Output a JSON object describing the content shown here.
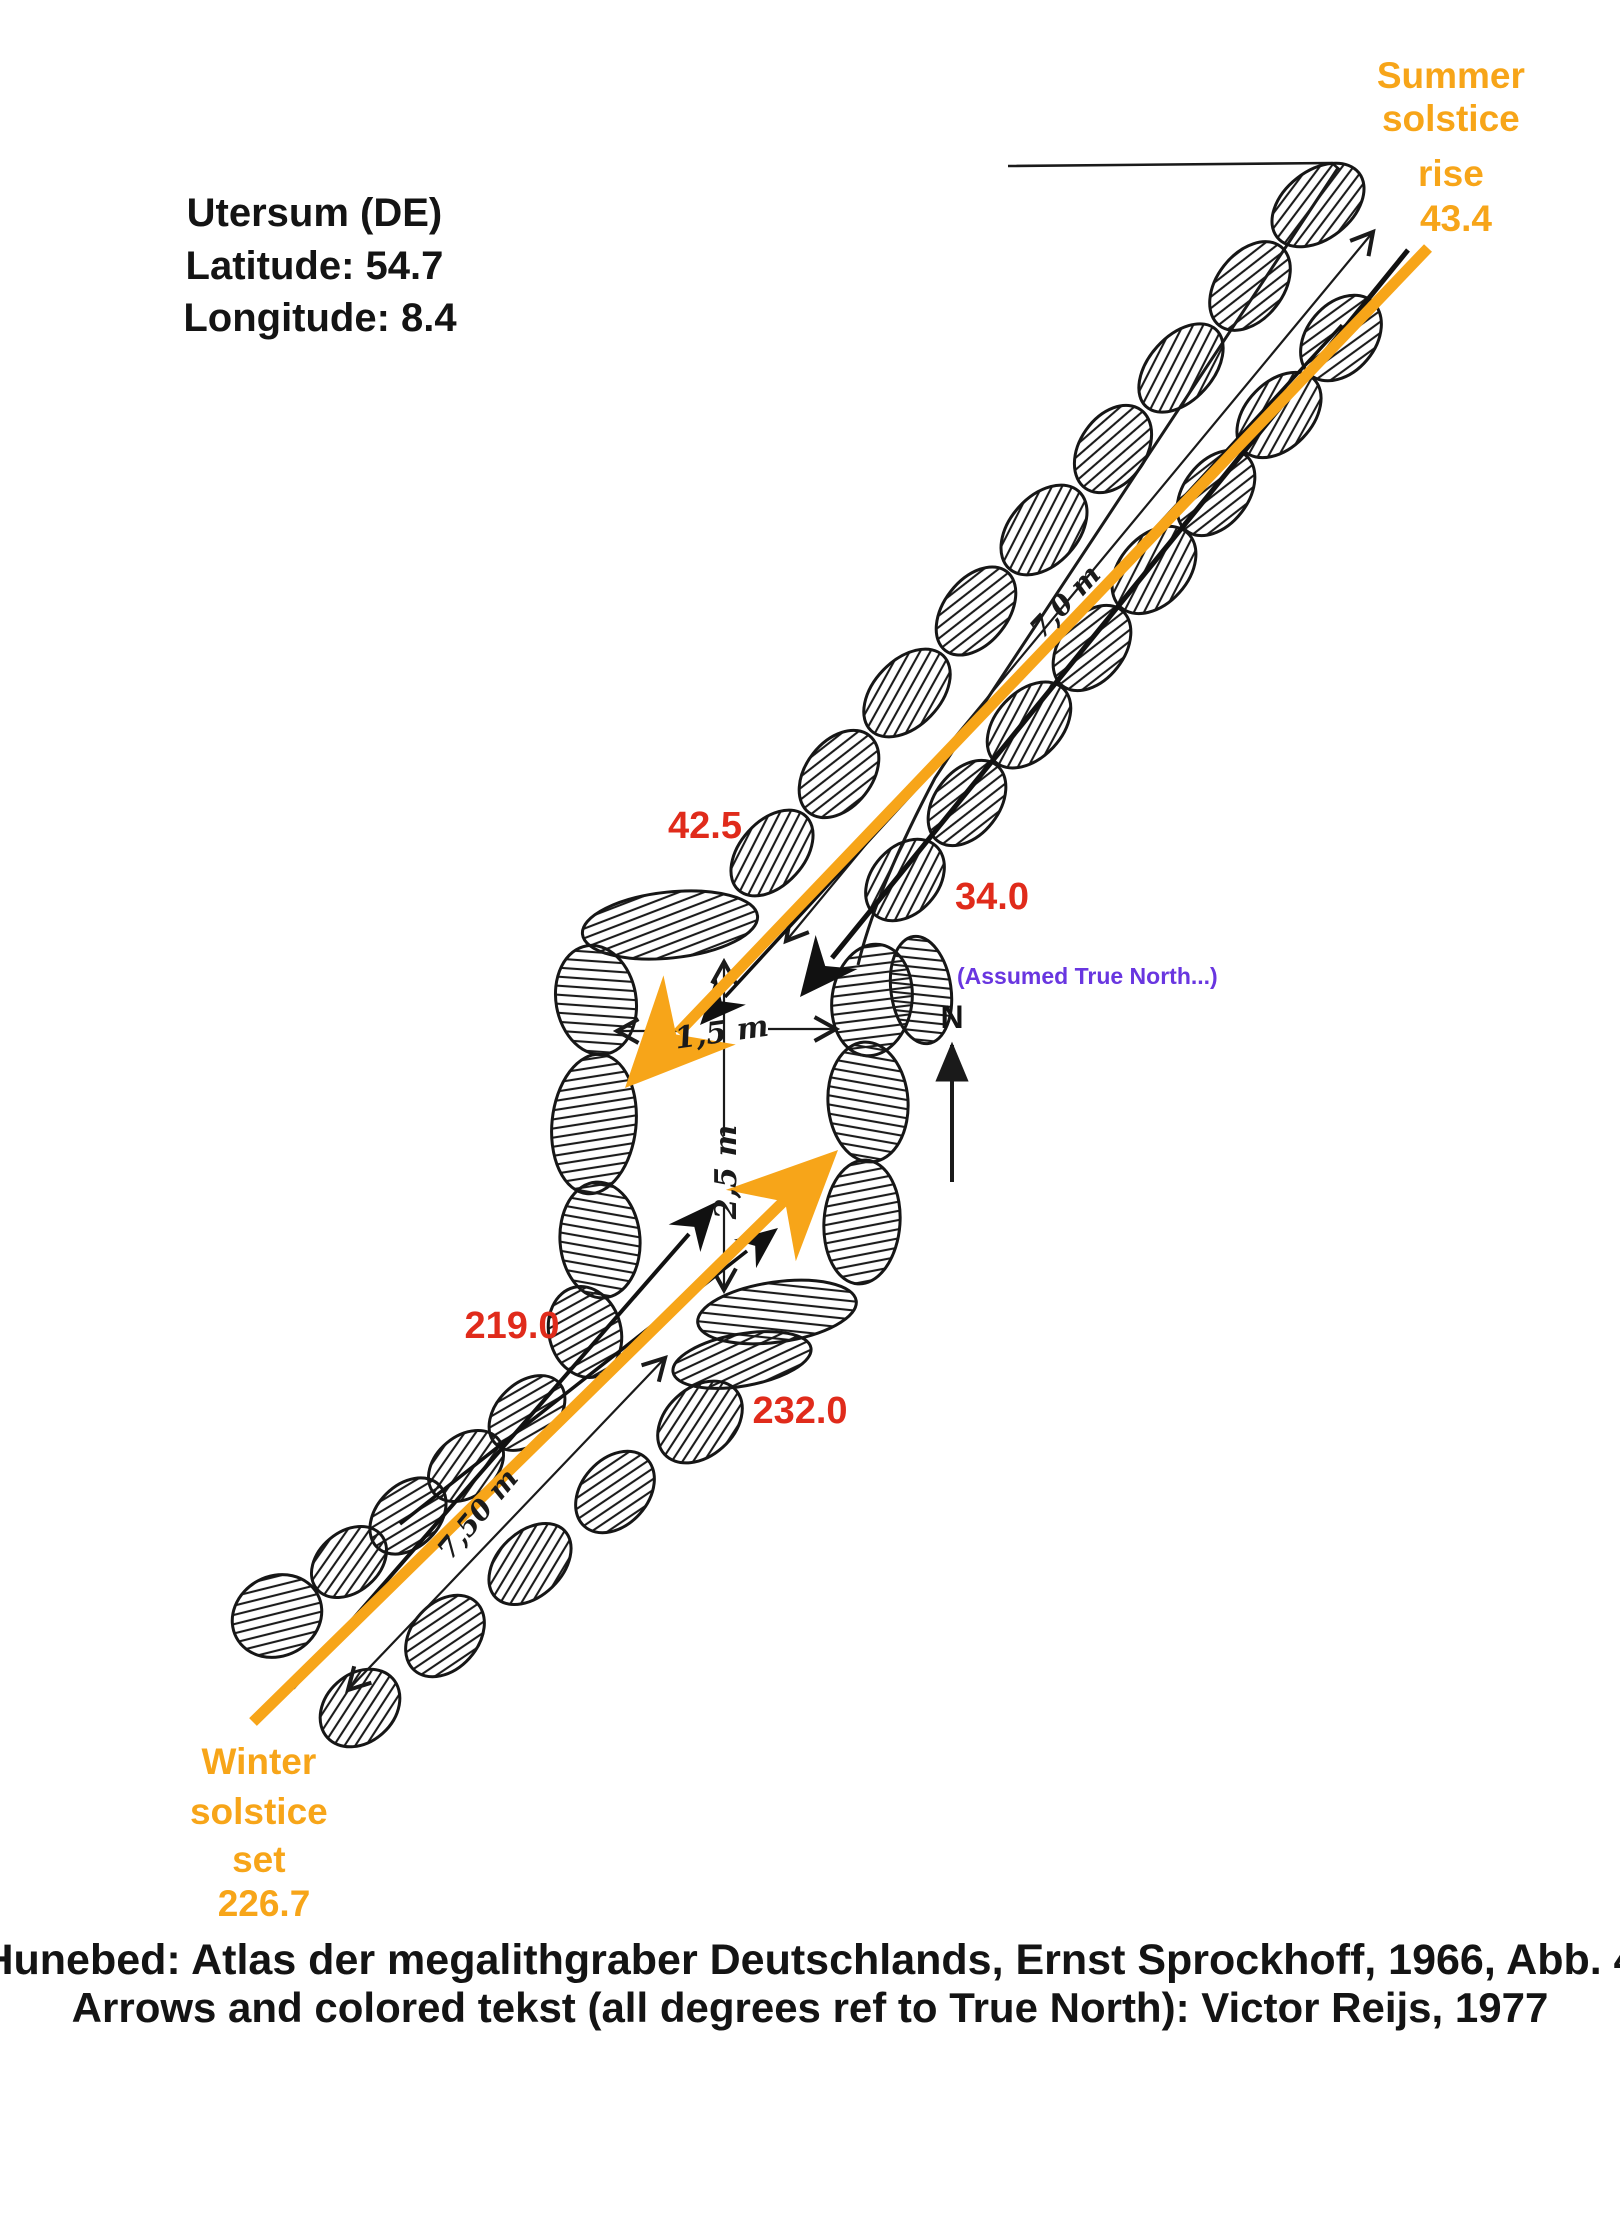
{
  "colors": {
    "orange": "#F7A519",
    "red": "#E02B1B",
    "purple": "#6936E0",
    "ink": "#141414"
  },
  "site_info": {
    "line1": "Utersum (DE)",
    "line2": "Latitude: 54.7",
    "line3": "Longitude: 8.4"
  },
  "solstice": {
    "summer": {
      "line1": "Summer",
      "line2": "solstice",
      "line3": "rise",
      "line4": "43.4"
    },
    "winter": {
      "line1": "Winter",
      "line2": "solstice",
      "line3": "set",
      "line4": "226.7"
    }
  },
  "azimuth_labels": {
    "upper_left": "42.5",
    "upper_right": "34.0",
    "lower_left": "219.0",
    "lower_right": "232.0"
  },
  "north": {
    "note": "(Assumed True North...)",
    "letter": "N"
  },
  "dimension_labels": {
    "chamber_width": "1,5 m",
    "chamber_length": "2,5 m",
    "upper_passage": "7,0 m",
    "lower_passage": "7,50 m"
  },
  "caption": {
    "line1": "Hunebed: Atlas der megalithgraber Deutschlands, Ernst Sprockhoff, 1966, Abb. 4",
    "line2": "Arrows and colored tekst (all degrees ref to True North): Victor Reijs, 1977"
  }
}
